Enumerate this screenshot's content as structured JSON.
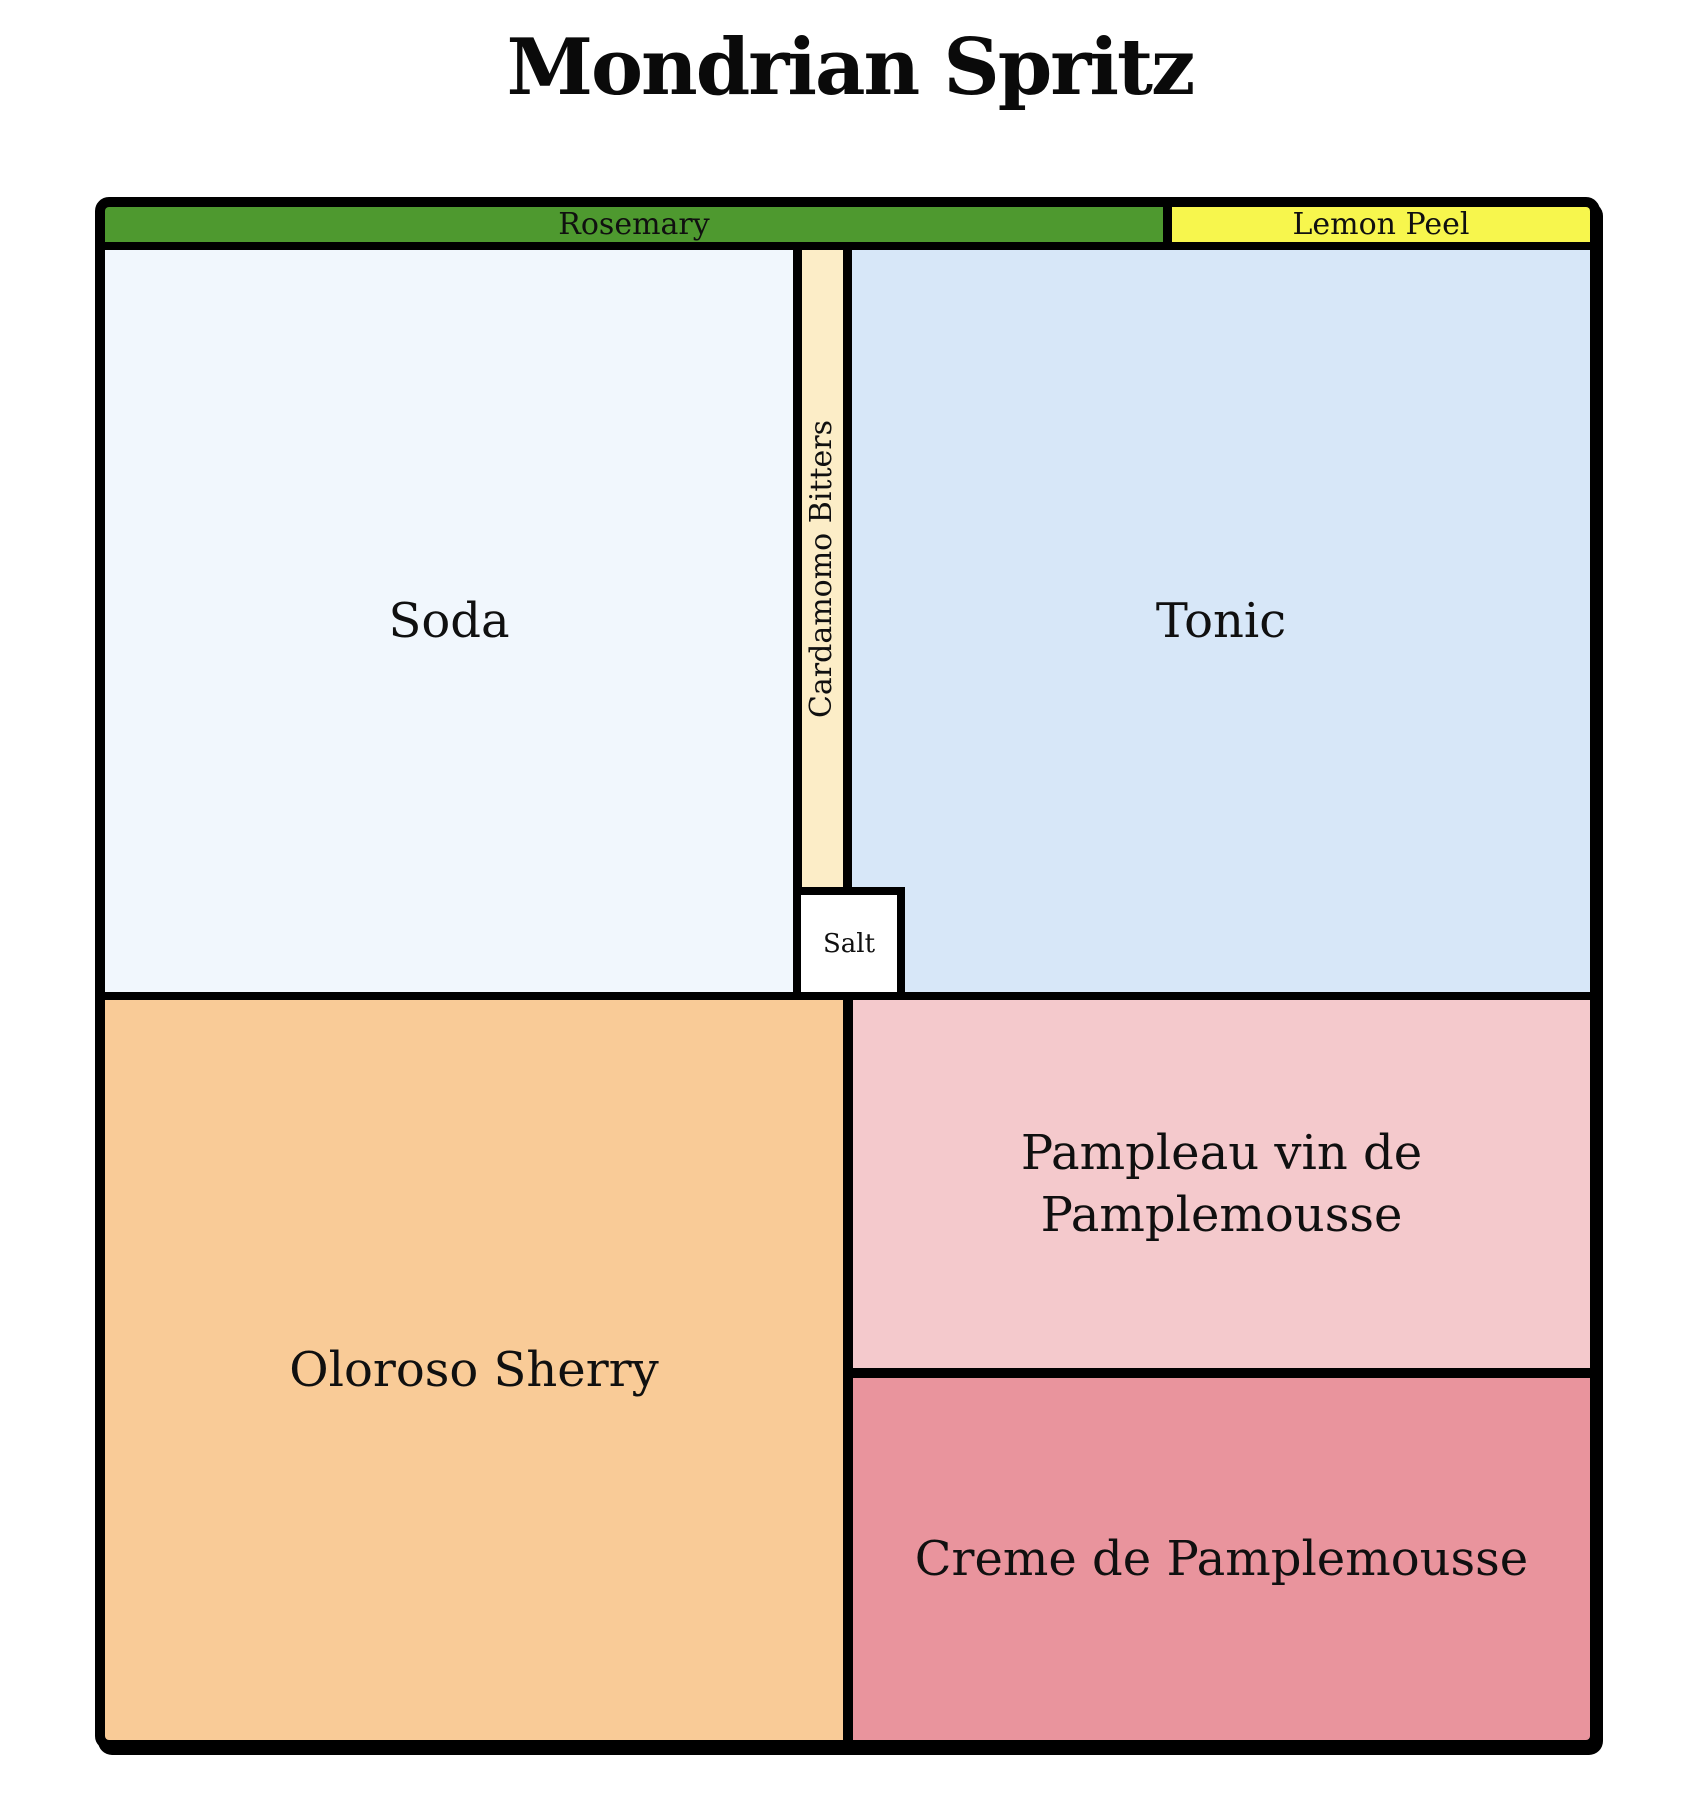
{
  "title": {
    "text": "Mondrian Spritz"
  },
  "frame": {
    "border_color": "#000000",
    "background": "#ffffff"
  },
  "regions": {
    "rosemary": {
      "label": "Rosemary",
      "color": "#4e992f"
    },
    "lemon_peel": {
      "label": "Lemon Peel",
      "color": "#f7f64d"
    },
    "soda": {
      "label": "Soda",
      "color": "#f1f7fd"
    },
    "cardamomo_bitters": {
      "label": "Cardamomo Bitters",
      "color": "#fcedc7"
    },
    "tonic": {
      "label": "Tonic",
      "color": "#d7e7f8"
    },
    "salt": {
      "label": "Salt",
      "color": "#ffffff"
    },
    "oloroso_sherry": {
      "label": "Oloroso Sherry",
      "color": "#f9cb97"
    },
    "pampleau": {
      "label": "Pampleau vin de Pamplemousse",
      "color": "#f4c9cc"
    },
    "creme": {
      "label": "Creme de Pamplemousse",
      "color": "#e9949d"
    }
  }
}
